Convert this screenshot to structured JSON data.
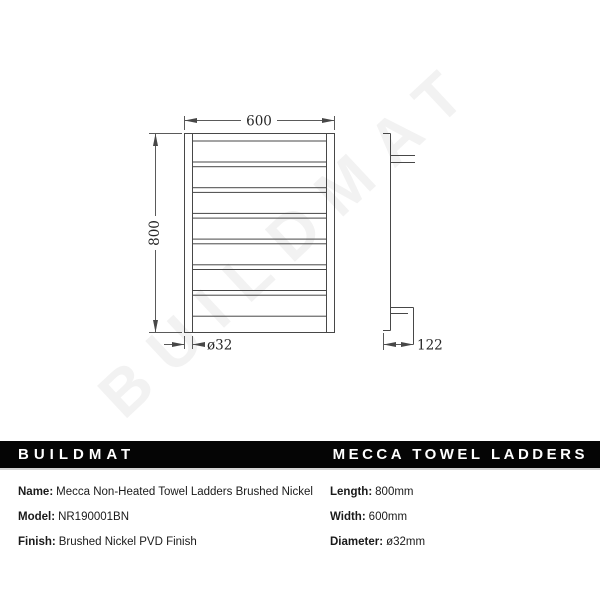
{
  "drawing": {
    "watermark": "BUILDMAT",
    "front_view": {
      "width_dim": "600",
      "height_dim": "800",
      "bar_dim": "ø32"
    },
    "side_view": {
      "depth_dim": "122"
    }
  },
  "banner": {
    "brand": "BUILDMAT",
    "product_line": "MECCA TOWEL LADDERS",
    "bg_color": "#050505",
    "fg_color": "#ffffff"
  },
  "specs": {
    "left": [
      {
        "label": "Name:",
        "value": "Mecca Non-Heated Towel Ladders Brushed Nickel"
      },
      {
        "label": "Model:",
        "value": "NR190001BN"
      },
      {
        "label": "Finish:",
        "value": "Brushed Nickel PVD Finish"
      }
    ],
    "right": [
      {
        "label": "Length:",
        "value": "800mm"
      },
      {
        "label": "Width:",
        "value": "600mm"
      },
      {
        "label": "Diameter:",
        "value": "ø32mm"
      }
    ]
  },
  "colors": {
    "line": "#474747",
    "dimension_text": "#262626",
    "watermark": "#f2f2f2",
    "background": "#ffffff"
  }
}
